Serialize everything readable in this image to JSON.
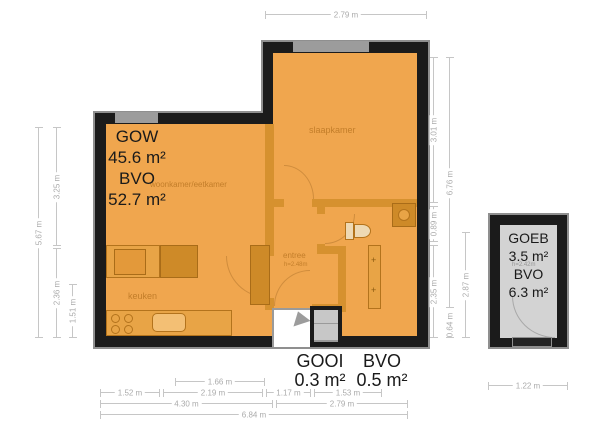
{
  "plan": {
    "rooms": {
      "living": "woonkamer/eetkamer",
      "bedroom": "slaapkamer",
      "kitchen": "keuken",
      "entry": "entree",
      "entry_height": "h=2.48m",
      "shed_height": "h=2.42m"
    },
    "areas": {
      "main": {
        "l1": "GOW",
        "v1": "45.6 m²",
        "l2": "BVO",
        "v2": "52.7 m²"
      },
      "porch": {
        "l1": "GOOI",
        "v1": "0.3 m²",
        "l2": "BVO",
        "v2": "0.5 m²"
      },
      "shed": {
        "l1": "GOEB",
        "v1": "3.5 m²",
        "l2": "BVO",
        "v2": "6.3 m²"
      }
    },
    "dims": {
      "top": "2.79 m",
      "left_total": "5.67 m",
      "left_upper": "3.25 m",
      "left_lower": "2.36 m",
      "left_kitchen": "1.51 m",
      "right_bed": "3.01 m",
      "right_mid": "0.89 m",
      "right_low": "2.35 m",
      "right_total": "6.76 m",
      "right_bottom": "0.64 m",
      "right_lower2": "2.87 m",
      "b_166": "1.66 m",
      "b_152": "1.52 m",
      "b_219": "2.19 m",
      "b_117": "1.17 m",
      "b_153": "1.53 m",
      "b_430": "4.30 m",
      "b_279": "2.79 m",
      "b_684": "6.84 m",
      "shed_bottom": "1.22 m"
    },
    "colors": {
      "floor": "#F0A64E",
      "wall": "#1B1B1B",
      "partition": "#D6912F",
      "shed_floor": "#D3D3D3",
      "dimension": "#C6C6C6"
    }
  }
}
